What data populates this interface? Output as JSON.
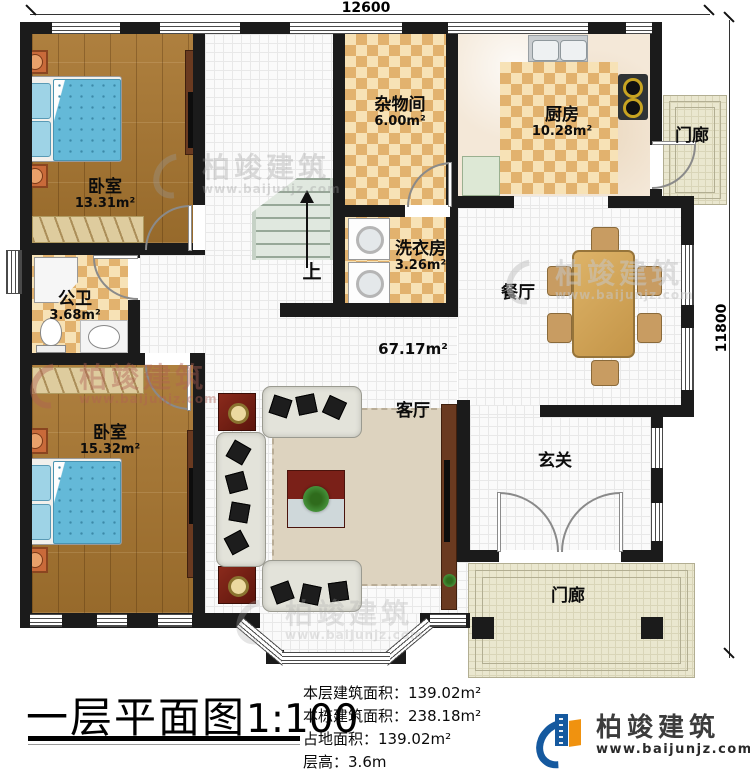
{
  "plan": {
    "dim_width": "12600",
    "dim_height": "11800",
    "stairs_label": "上"
  },
  "rooms": [
    {
      "name": "卧室",
      "area": "13.31m²"
    },
    {
      "name": "公卫",
      "area": "3.68m²"
    },
    {
      "name": "卧室",
      "area": "15.32m²"
    },
    {
      "name": "杂物间",
      "area": "6.00m²"
    },
    {
      "name": "洗衣房",
      "area": "3.26m²"
    },
    {
      "name": "厨房",
      "area": "10.28m²"
    },
    {
      "name": "餐厅",
      "area": ""
    },
    {
      "name": "客厅",
      "area": "67.17m²"
    },
    {
      "name": "玄关",
      "area": ""
    },
    {
      "name": "门廊",
      "area": ""
    },
    {
      "name": "门廊",
      "area": ""
    }
  ],
  "title": {
    "text": "一层平面图",
    "scale": "1:100"
  },
  "stats": [
    {
      "label": "本层建筑面积：",
      "value": "139.02m²"
    },
    {
      "label": "本栋建筑面积：",
      "value": "238.18m²"
    },
    {
      "label": "占地面积：",
      "value": "139.02m²"
    },
    {
      "label": "层高：",
      "value": "3.6m"
    }
  ],
  "brand": {
    "name": "柏竣建筑",
    "url": "www.baijunjz.com"
  },
  "watermark": {
    "name": "柏竣建筑",
    "url": "www.baijunjz.com"
  },
  "colors": {
    "wall": "#1b1b1b",
    "wood": "#a87630",
    "checker": "#e2b26e",
    "accent_blue": "#15599f",
    "accent_orange": "#f0920f"
  }
}
